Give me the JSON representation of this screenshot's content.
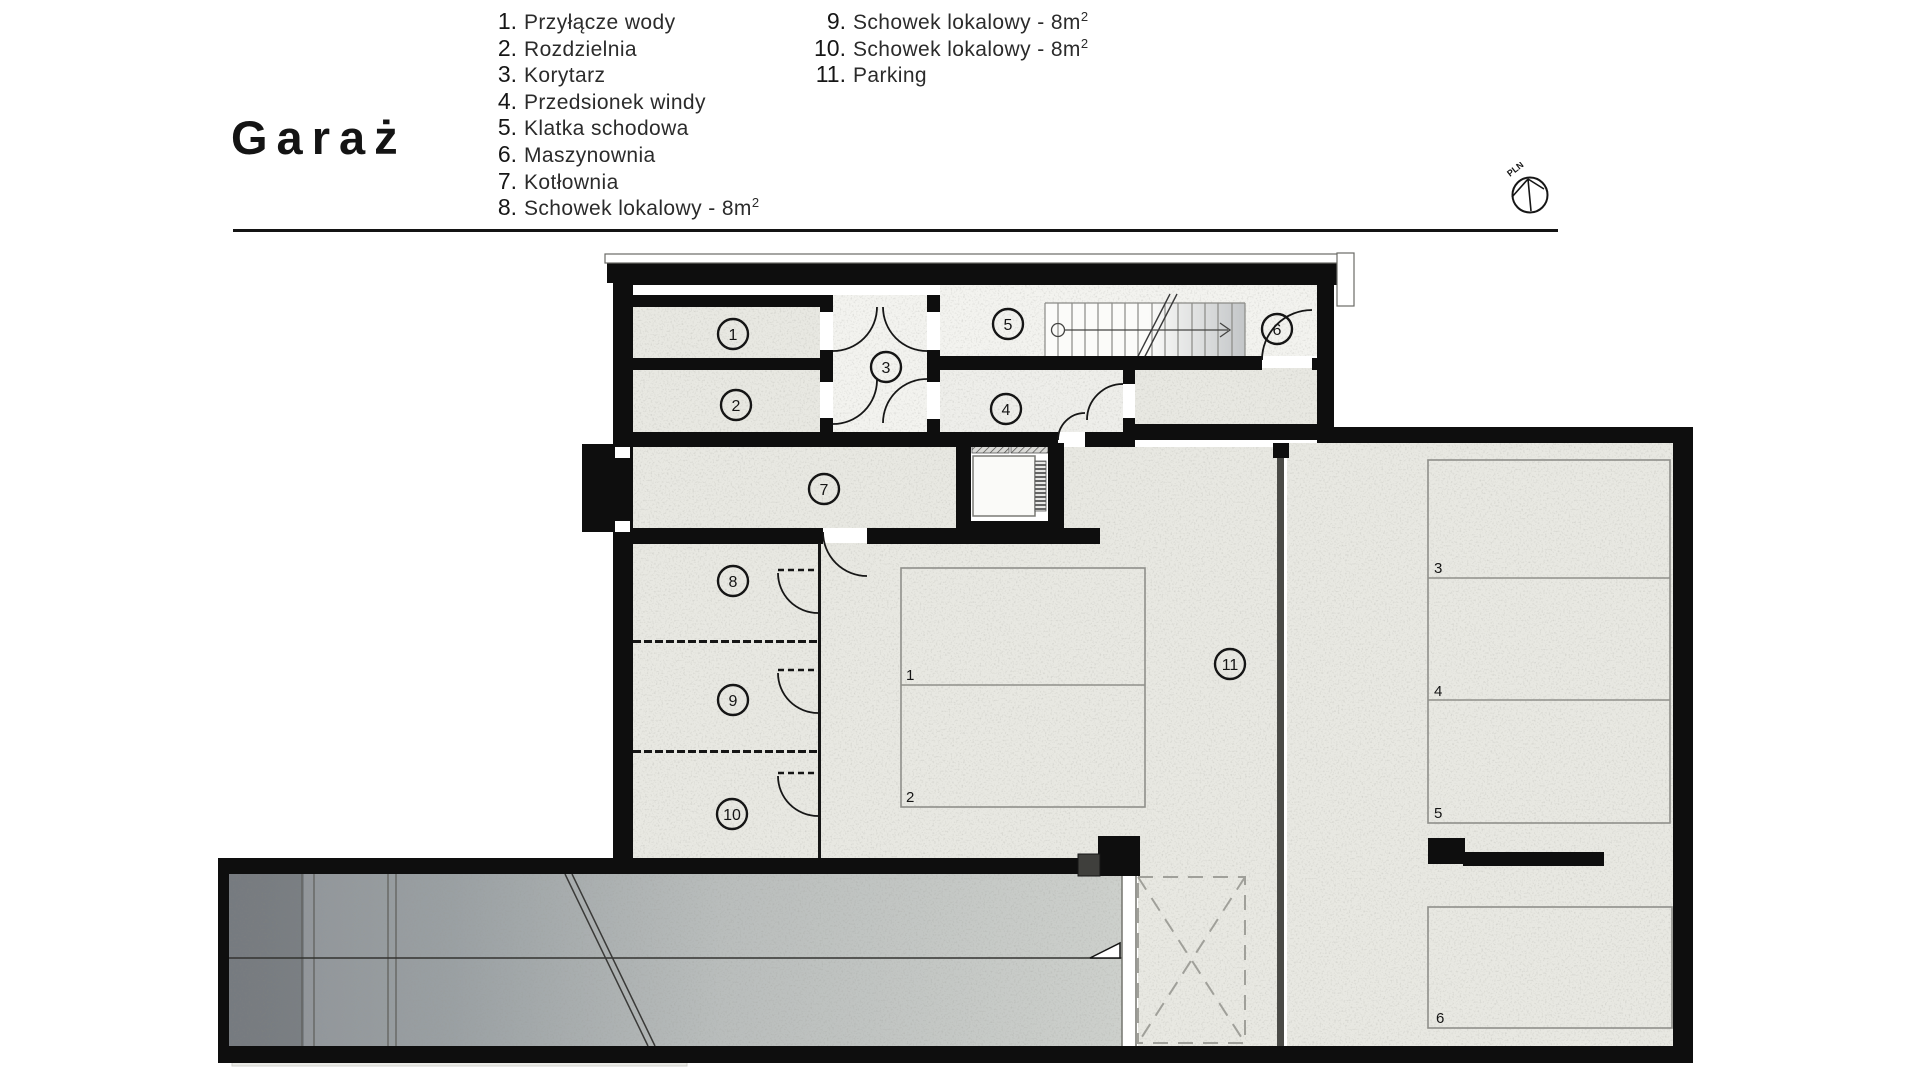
{
  "page": {
    "title": "Garaż"
  },
  "legend": {
    "col1": [
      {
        "num": "1.",
        "label": "Przyłącze wody",
        "sup": ""
      },
      {
        "num": "2.",
        "label": "Rozdzielnia",
        "sup": ""
      },
      {
        "num": "3.",
        "label": "Korytarz",
        "sup": ""
      },
      {
        "num": "4.",
        "label": "Przedsionek windy",
        "sup": ""
      },
      {
        "num": "5.",
        "label": "Klatka schodowa",
        "sup": ""
      },
      {
        "num": "6.",
        "label": "Maszynownia",
        "sup": ""
      },
      {
        "num": "7.",
        "label": "Kotłownia",
        "sup": ""
      },
      {
        "num": "8.",
        "label": "Schowek lokalowy - 8m",
        "sup": "2"
      }
    ],
    "col2": [
      {
        "num": "9.",
        "label": "Schowek lokalowy - 8m",
        "sup": "2"
      },
      {
        "num": "10.",
        "label": "Schowek lokalowy - 8m",
        "sup": "2"
      },
      {
        "num": "11.",
        "label": "Parking",
        "sup": ""
      }
    ]
  },
  "compass": {
    "label": "PLN"
  },
  "plan": {
    "room_numbers": [
      "1",
      "2",
      "3",
      "4",
      "5",
      "6",
      "7",
      "8",
      "9",
      "10",
      "11"
    ],
    "parking_spots": [
      "1",
      "2",
      "3",
      "4",
      "5",
      "6"
    ],
    "colors": {
      "wall": "#0e0e0e",
      "concrete": "#e8e8e2",
      "light_floor": "#f3f3ef",
      "ramp_dark": "#8d9196",
      "ramp_light": "#cdd0cc"
    }
  }
}
